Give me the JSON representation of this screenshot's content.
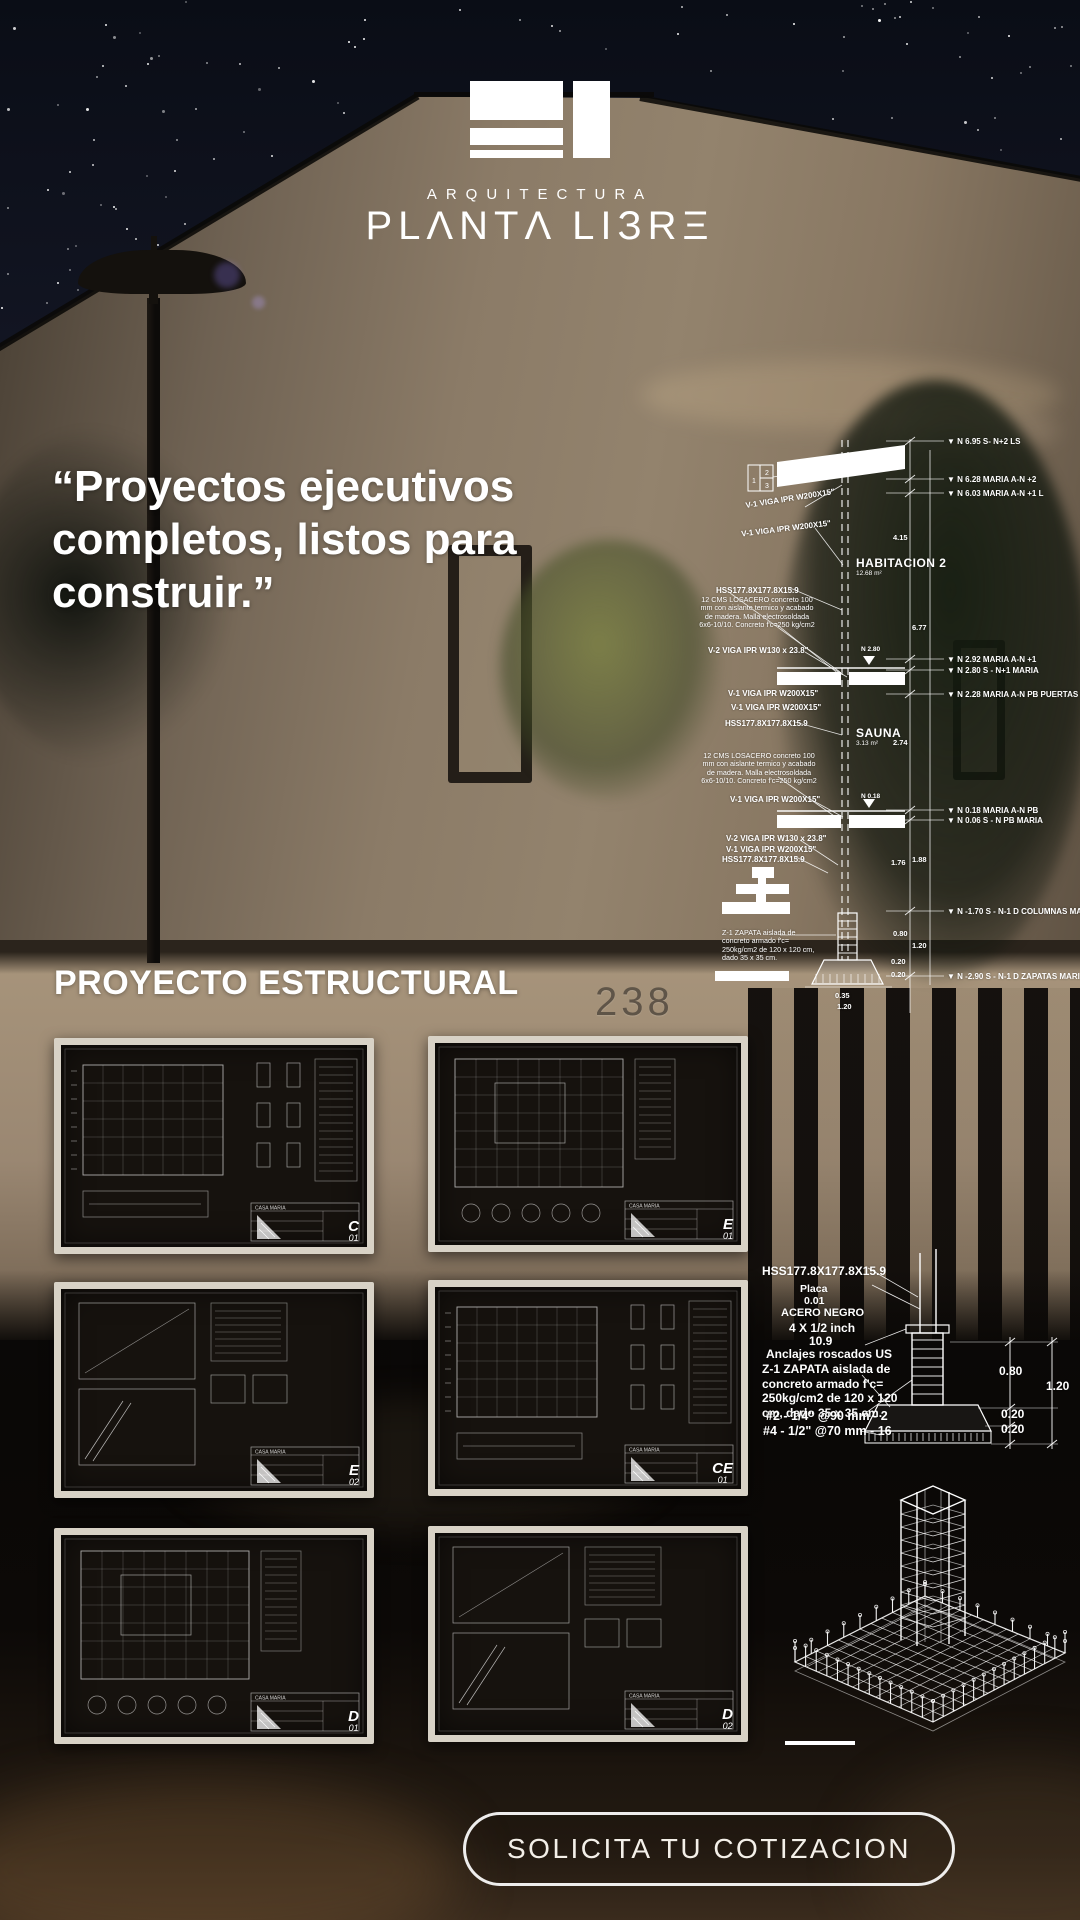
{
  "brand": {
    "tagline": "ARQUITECTURA",
    "name": "PLANTA LIBRE",
    "name_display": "PLΛNTΛ LIЗRΞ"
  },
  "quote_lines": [
    "“Proyectos ejecutivos",
    "completos, listos para",
    "construir.”"
  ],
  "heading": "PROYECTO ESTRUCTURAL",
  "house_number": "238",
  "cta_label": "SOLICITA TU COTIZACION",
  "section": {
    "key_box": [
      "1",
      "2",
      "3"
    ],
    "levels": [
      {
        "elev": "N 6.95",
        "name": "S- N+2 LS"
      },
      {
        "elev": "N 6.28",
        "name": "MARIA A-N +2"
      },
      {
        "elev": "N 6.03",
        "name": "MARIA A-N +1 L"
      },
      {
        "elev": "N 2.92",
        "name": "MARIA A-N +1"
      },
      {
        "elev": "N 2.80",
        "name": "S - N+1 MARIA"
      },
      {
        "elev": "N 2.28",
        "name": "MARIA A-N PB PUERTAS"
      },
      {
        "elev": "N 0.18",
        "name": "MARIA A-N PB"
      },
      {
        "elev": "N 0.06",
        "name": "S - N PB MARIA"
      },
      {
        "elev": "N -1.70",
        "name": "S - N-1 D COLUMNAS MARIA"
      },
      {
        "elev": "N -2.90",
        "name": "S - N-1 D ZAPATAS MARIA"
      }
    ],
    "members": [
      "V-1 VIGA IPR W200X15\"",
      "V-1 VIGA IPR W200X15\"",
      "HSS177.8X177.8X15.9",
      "V-2 VIGA IPR W130 x 23.8\"",
      "V-1 VIGA IPR W200X15\"",
      "V-1 VIGA IPR W200X15\"",
      "HSS177.8X177.8X15.9",
      "V-1 VIGA IPR W200X15\"",
      "V-2 VIGA IPR W130 x 23.8\"",
      "V-1 VIGA IPR W200X15\"",
      "HSS177.8X177.8X15.9"
    ],
    "floor_marks": [
      "N 2.80",
      "N 0.18"
    ],
    "rooms": [
      {
        "name": "HABITACION 2",
        "area": "12.68 m²"
      },
      {
        "name": "SAUNA",
        "area": "3.13 m²"
      }
    ],
    "losacero_note": [
      "12 CMS LOSACERO concreto",
      "100 mm con aislante termico y",
      "acabado de madera. Malla",
      "electrosoldada 6x6-10/10.",
      "Concreto f'c=250 kg/cm2"
    ],
    "zapata_note": [
      "Z-1 ZAPATA aislada de",
      "concreto armado f'c=",
      "250kg/cm2 de 120 x 120",
      "cm, dado 35 x 35 cm."
    ],
    "dims": [
      "4.15",
      "6.77",
      "2.74",
      "1.76",
      "1.88",
      "0.80",
      "1.20",
      "0.20",
      "0.20",
      "0.35",
      "1.20"
    ]
  },
  "sheets": {
    "title_block": "CASA MARIA",
    "codes": [
      {
        "code": "C",
        "num": "01"
      },
      {
        "code": "E",
        "num": "01"
      },
      {
        "code": "E",
        "num": "02"
      },
      {
        "code": "CE",
        "num": "01"
      },
      {
        "code": "D",
        "num": "01"
      },
      {
        "code": "D",
        "num": "02"
      }
    ]
  },
  "detail": {
    "callout_lines": [
      "HSS177.8X177.8X15.9",
      "Placa",
      "0.01",
      "ACERO NEGRO",
      "4 X 1/2 inch",
      "10.9",
      "Anclajes roscados US"
    ],
    "zapata_note": [
      "Z-1 ZAPATA aislada de",
      "concreto armado f'c=",
      "250kg/cm2 de 120 x 120",
      "cm, dado 35 x 35 cm."
    ],
    "rebar_notes": [
      "#2 - 1/4\" @90 mm - 2",
      "#4 - 1/2\" @70 mm - 16"
    ],
    "dims": [
      "0.80",
      "1.20",
      "0.20",
      "0.20"
    ]
  },
  "colors": {
    "accent_white": "#ffffff",
    "sky": "#10131d",
    "wall": "#8b7b67",
    "sheet_bg": "#16120e",
    "sheet_border": "#d8d2c6"
  }
}
